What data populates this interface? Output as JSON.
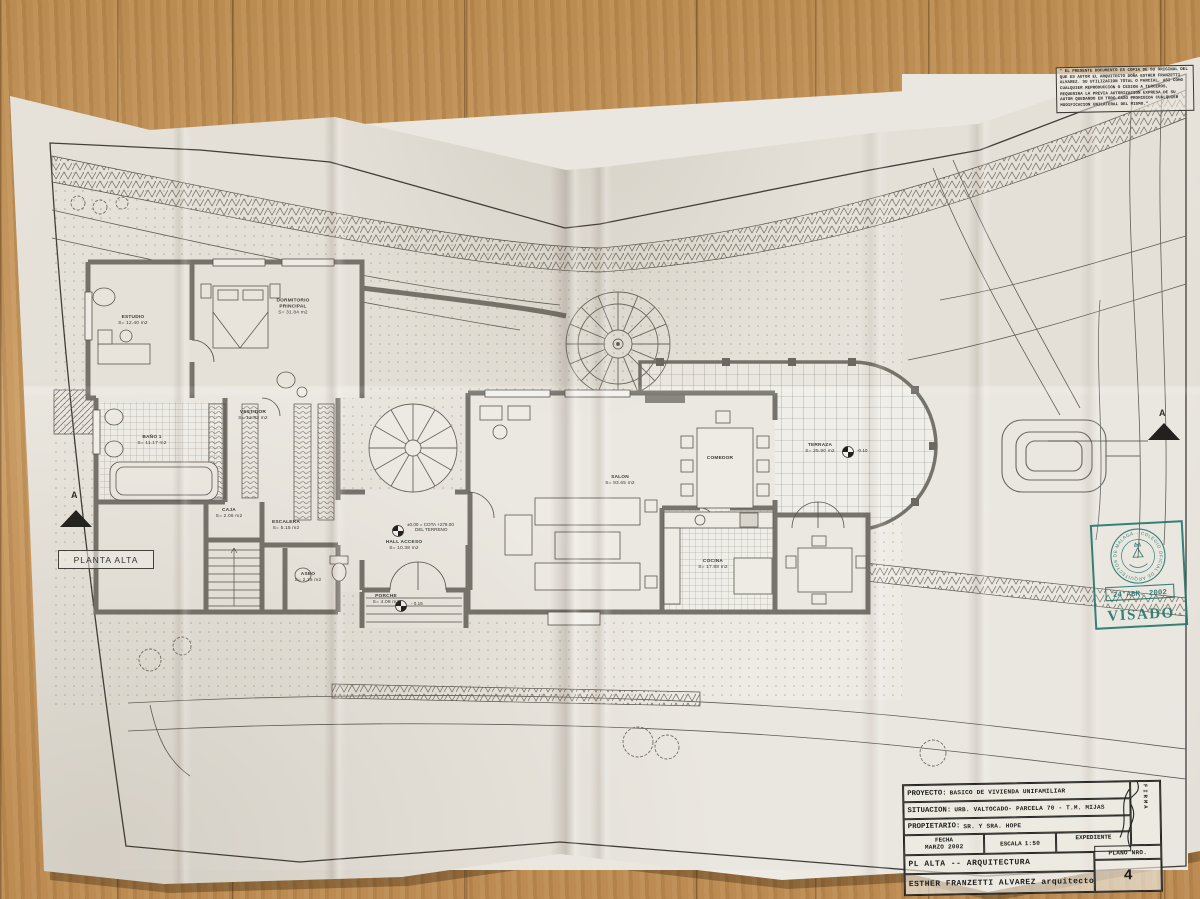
{
  "document": {
    "plan_label": "PLANTA ALTA",
    "disclaimer": "\" EL PRESENTE DOCUMENTO ES COPIA DE SU ORIGINAL DEL QUE ES AUTOR EL ARQUITECTO DOÑA ESTHER FRANZETTI ALVAREZ. SU UTILIZACION TOTAL O PARCIAL, ASI COMO CUALQUIER REPRODUCCION O CESION A TERCEROS, REQUERIRA LA PREVIA AUTORIZACION EXPRESA DE SU AUTOR QUEDANDO EN TODO CASO PROHIBIDA CUALQUIER MODIFICACION UNILATERAL DEL MISMO.\""
  },
  "rooms": [
    {
      "name": "ESTUDIO",
      "area": "S= 12.40 m2"
    },
    {
      "name": "DORMITORIO PRINCIPAL",
      "area": "S= 31.84 m2"
    },
    {
      "name": "BAÑO 1",
      "area": "S= 11.17 m2"
    },
    {
      "name": "VESTIDOR",
      "area": "S= 12.83 m2"
    },
    {
      "name": "CAJA",
      "area": "S= 2.06 m2"
    },
    {
      "name": "ESCALERA",
      "area": "S= 5.15 m2"
    },
    {
      "name": "ASEO",
      "area": "S= 2.15 m2"
    },
    {
      "name": "HALL ACCESO",
      "area": "S= 10.38 m2"
    },
    {
      "name": "PORCHE",
      "area": "S= 4.08 m2"
    },
    {
      "name": "SALON",
      "area": "S= 93.65 m2"
    },
    {
      "name": "COMEDOR",
      "area": ""
    },
    {
      "name": "COCINA",
      "area": "S= 17.88 m2"
    },
    {
      "name": "TERRAZA",
      "area": "S= 25.90 m2"
    }
  ],
  "annotations": {
    "cota_line1": "±0.00 = COTA +278.00",
    "cota_line2": "DEL TERRENO",
    "level_porche": "- 0.15",
    "level_terraza": "-0.10",
    "section_letter": "A"
  },
  "stamp": {
    "ring_text": "· COLEGIO OFICIAL DE ARQUITECTOS DE MALAGA ·",
    "date": "24 ABR. 2002",
    "label": "VISADO",
    "color": "#22756c"
  },
  "titleblock": {
    "proyecto_label": "PROYECTO:",
    "proyecto": "BASICO  DE VIVIENDA UNIFAMILIAR",
    "situacion_label": "SITUACION:",
    "situacion": "URB. VALTOCADO- PARCELA 70 - T.M.  MIJAS",
    "propietario_label": "PROPIETARIO:",
    "propietario": "SR. Y SRA.  HOPE",
    "fecha_label": "FECHA",
    "fecha": "MARZO 2002",
    "escala_label": "ESCALA",
    "escala": "1:50",
    "expediente_label": "EXPEDIENTE",
    "plano_title": "PL ALTA --  ARQUITECTURA",
    "autor": "ESTHER FRANZETTI ALVAREZ  arquitecto",
    "firma_label": "FIRMA",
    "plano_nro_label": "PLANO NRO.",
    "plano_nro": "4"
  }
}
